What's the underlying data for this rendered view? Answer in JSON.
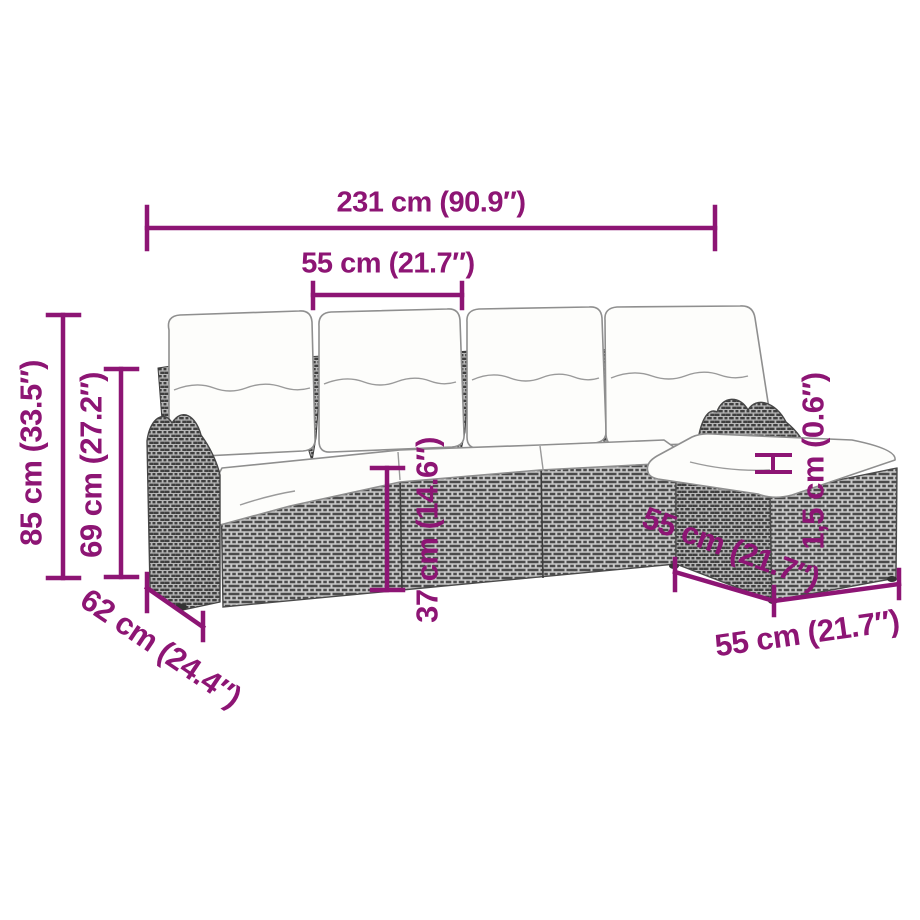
{
  "figure": {
    "kind": "product-dimension-diagram",
    "subject": "rattan-corner-sofa-set-with-cushions",
    "accent_color": "#8d1574",
    "wicker_dark": "#4b4b4b",
    "wicker_light": "#c9c9c9",
    "cushion_color": "#fdfdfb"
  },
  "dims": {
    "overall_width": {
      "label": "231 cm (90.9″)"
    },
    "seat_width": {
      "label": "55 cm (21.7″)"
    },
    "overall_height": {
      "label": "85 cm (33.5″)"
    },
    "back_height": {
      "label": "69 cm (27.2″)"
    },
    "base_height": {
      "label": "37 cm (14.6″)"
    },
    "side_depth": {
      "label": "62 cm (24.4″)"
    },
    "chaise_depth": {
      "label": "55 cm (21.7″)"
    },
    "cushion_thickness": {
      "label": "1,5 cm (0.6″)"
    },
    "ottoman_width": {
      "label": "55 cm (21.7″)"
    }
  }
}
